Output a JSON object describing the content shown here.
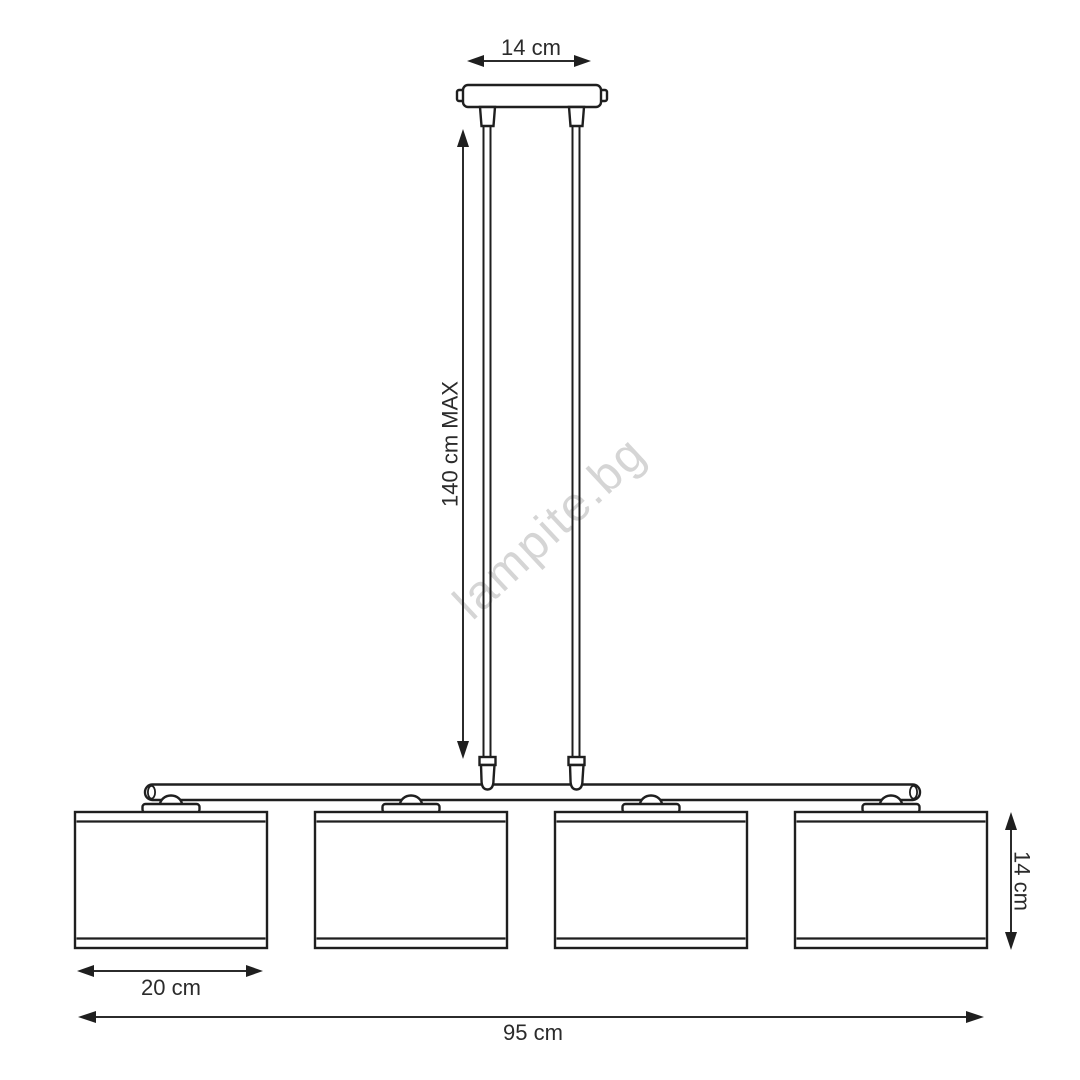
{
  "diagram": {
    "watermark": "lampite.bg",
    "dimensions": {
      "canopy_width": "14 cm",
      "suspension_max_height": "140 cm MAX",
      "shade_width": "20 cm",
      "shade_height": "14 cm",
      "total_width": "95 cm"
    },
    "colors": {
      "line": "#1f1f1f",
      "text": "#2b2b2b",
      "watermark": "#d5d5d5",
      "background": "#ffffff"
    }
  }
}
